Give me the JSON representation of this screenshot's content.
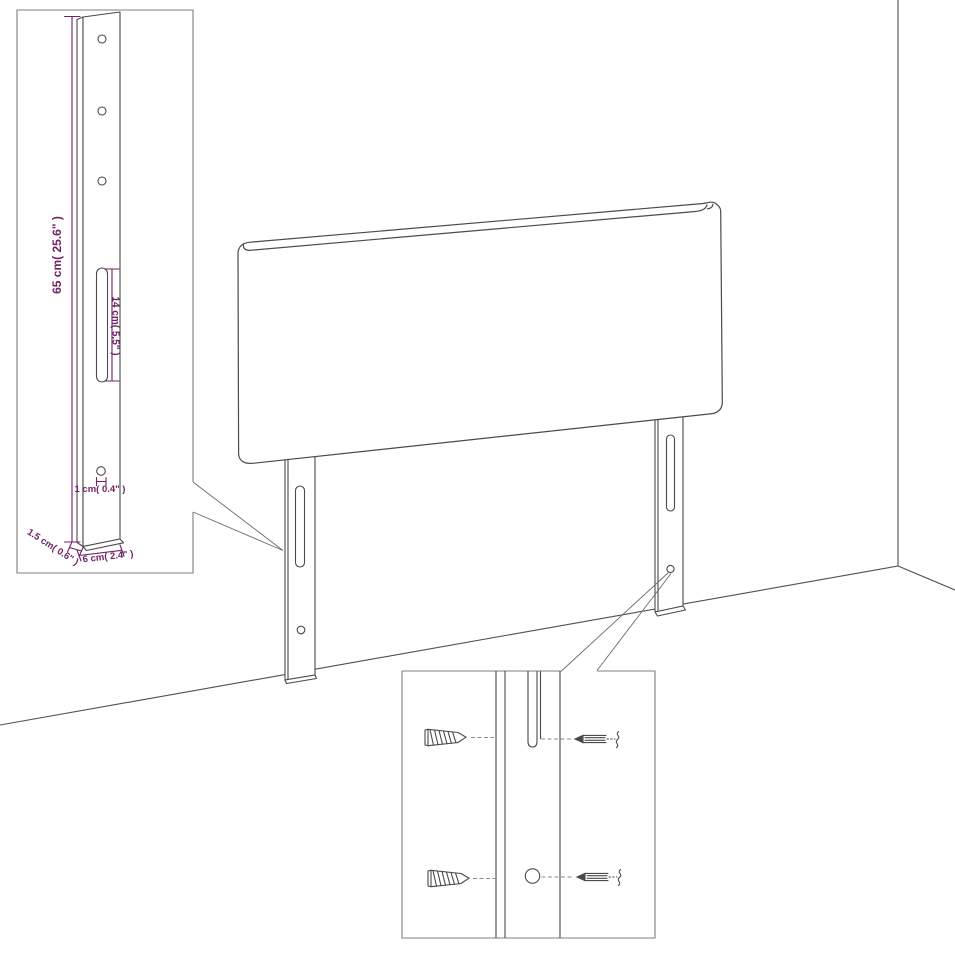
{
  "diagram": {
    "subject": "Upholstered headboard with two slotted mounting legs shown against a room corner, with a dimensioned leg inset and a mounting-hardware detail inset",
    "colors": {
      "background": "#ffffff",
      "line": "#4a4a4a",
      "inset_border": "#7f7f7f",
      "dimension": "#6f2163"
    },
    "inset_leg": {
      "labels": {
        "leg_height": "65 cm( 25.6\" )",
        "slot_length": "14 cm( 5.5\" )",
        "hole_size": "1 cm( 0.4\" )",
        "leg_thickness": "1.5 cm( 0.6\" )",
        "leg_width": "6 cm( 2.4\" )"
      }
    },
    "hardware_inset": {
      "parts": {
        "wood_screw": "wood-screw-icon",
        "bolt": "break-line-bolt-icon",
        "slot": "leg-slot",
        "hole": "leg-screw-hole"
      }
    }
  }
}
